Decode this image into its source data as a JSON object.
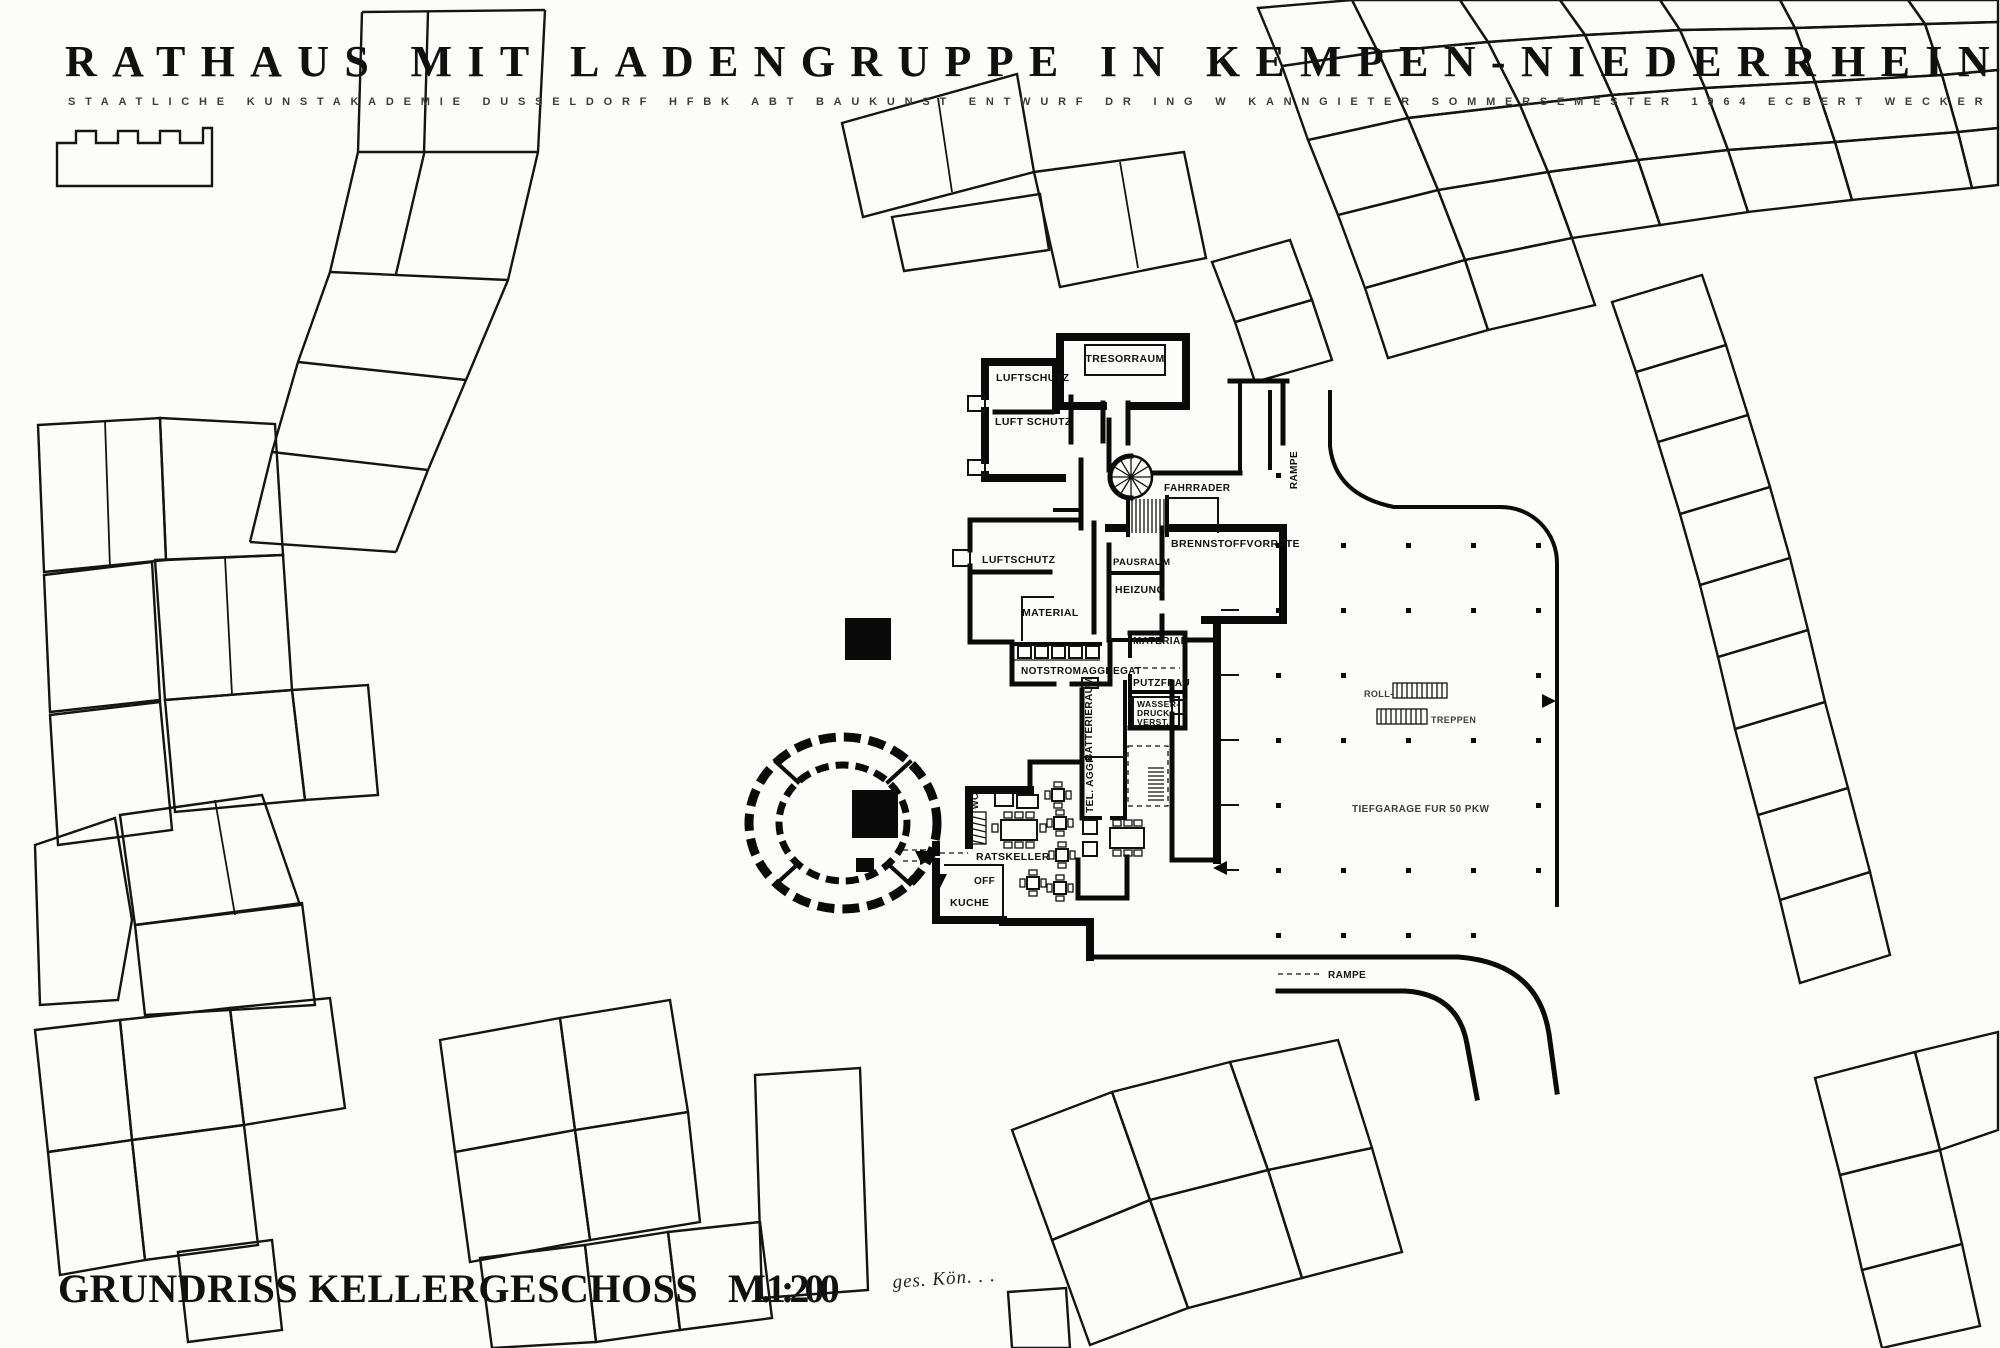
{
  "colors": {
    "ink": "#0a0a0a",
    "paper": "#fcfcfa"
  },
  "header": {
    "title": "RATHAUS MIT LADENGRUPPE IN KEMPEN-NIEDERRHEIN",
    "subtitle": "STAATLICHE KUNSTAKADEMIE DUSSELDORF   HFBK ABT BAUKUNST   ENTWURF DR ING W KANNGIETER   SOMMERSEMESTER 1964   ECBERT WECKER"
  },
  "footer": {
    "plan_title": "GRUNDRISS KELLERGESCHOSS",
    "scale": "M.1:200",
    "signature": "ges. Kön. . ."
  },
  "labels": {
    "tresorraum": "TRESORRAUM",
    "luftschutz_1": "LUFTSCHUTZ",
    "luftschutz_2": "LUFT SCHUTZ",
    "luftschutz_3": "LUFTSCHUTZ",
    "fahrraeder": "FAHRRADER",
    "pausraum": "PAUSRAUM",
    "brennstoffvorraete": "BRENNSTOFFVORRATE",
    "heizung": "HEIZUNG",
    "material_1": "MATERIAL",
    "material_2": "MATERIAL",
    "notstromaggregat": "NOTSTROMAGGREGAT",
    "putzfrau": "PUTZFRAU",
    "wasser_1": "WASSER-",
    "wasser_2": "DRUCK -",
    "wasser_3": "VERST.",
    "batterieraum": "BATTERIERAUM",
    "tel_aggr": "TEL. AGGR",
    "wc": "WC",
    "ratskeller": "RATSKELLER",
    "off": "OFF",
    "kueche": "KUCHE",
    "rolltreppe": "ROLL-",
    "treppen": "TREPPEN",
    "tiefgarage": "TIEFGARAGE FUR 50 PKW",
    "rampe_top": "RAMPE",
    "rampe_bottom": "RAMPE"
  }
}
